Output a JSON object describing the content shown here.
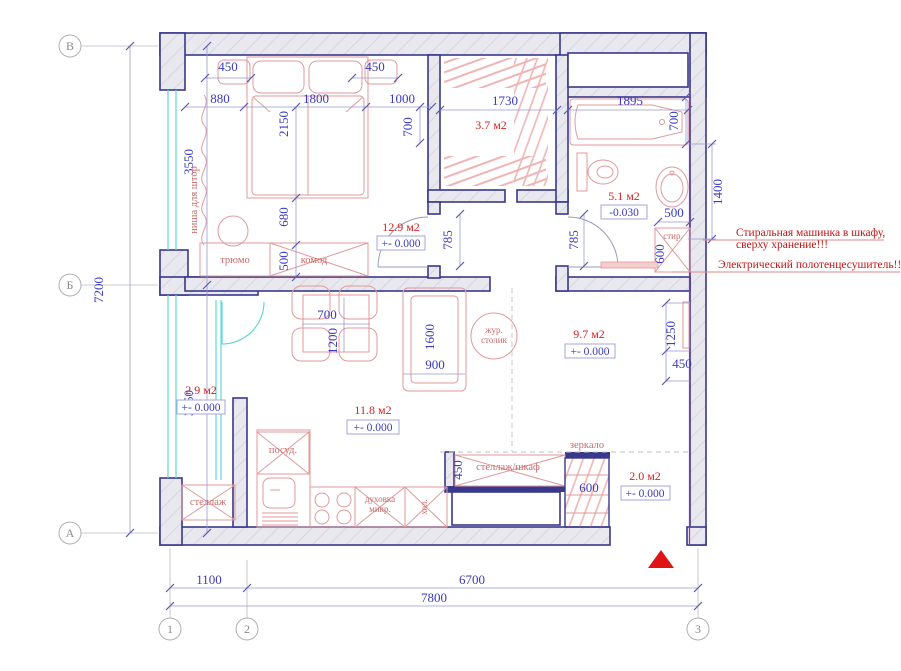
{
  "plan": {
    "axes": {
      "rows": [
        "В",
        "Б",
        "А"
      ],
      "cols": [
        "1",
        "2",
        "3"
      ]
    },
    "overall": {
      "left_upper": "3550",
      "left_total": "7200",
      "left_lower": "3650",
      "bottom_left": "1100",
      "bottom_right": "6700",
      "bottom_total": "7800"
    },
    "dims": {
      "ns_left": "450",
      "ns_right": "450",
      "w880": "880",
      "w1800": "1800",
      "w1000": "1000",
      "bed_len": "2150",
      "door_off": "700",
      "ward_w": "1730",
      "bath_len": "1895",
      "bath_w": "700",
      "d680": "680",
      "d500_komod": "500",
      "door_bed": "785",
      "door_bath": "785",
      "sink500": "500",
      "wash600": "600",
      "right1400": "1400",
      "tbl700": "700",
      "tbl1200": "1200",
      "sofa1600": "1600",
      "sofa900": "900",
      "tv1250": "1250",
      "tv450": "450",
      "shelf450": "450",
      "entry600": "600"
    },
    "rooms": [
      {
        "id": "bedroom",
        "area": "12.9 м2",
        "level": "+- 0.000"
      },
      {
        "id": "wardrobe",
        "area": "3.7 м2"
      },
      {
        "id": "bathroom",
        "area": "5.1 м2",
        "level": "-0.030"
      },
      {
        "id": "living",
        "area": "11.8 м2",
        "level": "+- 0.000"
      },
      {
        "id": "hall",
        "area": "9.7 м2",
        "level": "+- 0.000"
      },
      {
        "id": "loggia",
        "area": "2.9 м2",
        "level": "+- 0.000"
      },
      {
        "id": "entry",
        "area": "2.0 м2",
        "level": "+- 0.000"
      }
    ],
    "furniture": {
      "nisha": "ниша для штор",
      "tryumo": "трюмо",
      "komod": "комод",
      "zhur1": "жур.",
      "zhur2": "столик",
      "posud": "посуд.",
      "stellazh": "стеллаж",
      "dukh1": "духовка",
      "dukh2": "микр.",
      "khol": "хол.",
      "stshkaf": "стеллаж/шкаф",
      "zerkalo": "зеркало",
      "stir": "стир."
    },
    "annotations": {
      "washer1": "Стиральная машинка в шкафу,",
      "washer2": "сверху хранение!!!",
      "towel": "Электрический полотенцесушитель!!!"
    },
    "colors": {
      "wall_stroke": "#38388c",
      "dim_text": "#3a3abf",
      "area_text": "#d42222",
      "furniture": "#e09a9a",
      "glazing": "#62d8d8",
      "annotation": "#c21414",
      "entry_arrow": "#e01414",
      "party_wall": "#a727a7"
    }
  }
}
